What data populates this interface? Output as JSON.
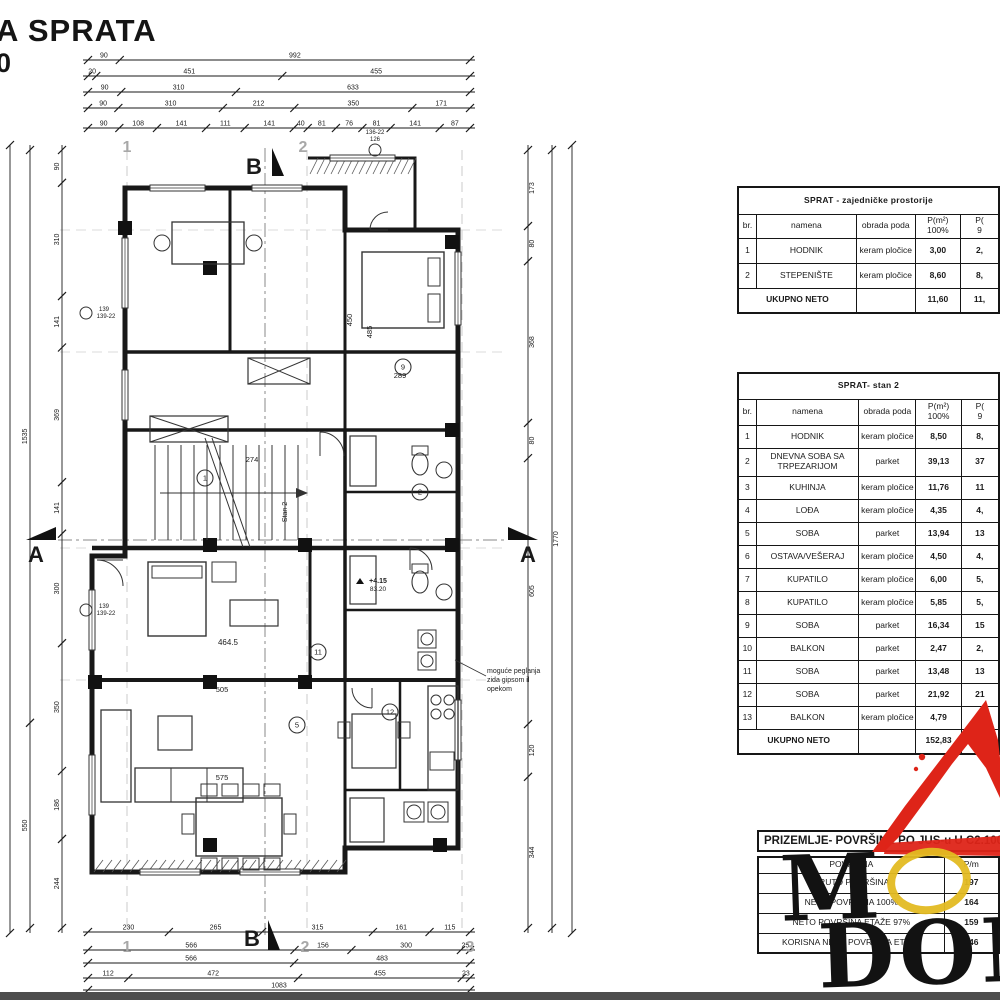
{
  "title": {
    "heading": "A SPRATA",
    "scale": "0"
  },
  "tables": {
    "common": {
      "title": "SPRAT - zajedničke prostorije",
      "columns": [
        {
          "l1": "br."
        },
        {
          "l1": "namena"
        },
        {
          "l1": "obrada poda"
        },
        {
          "l1": "P(m²)",
          "l2": "100%"
        },
        {
          "l1": "P(",
          "l2": "9"
        }
      ],
      "rows": [
        [
          "1",
          "HODNIK",
          "keram pločice",
          "3,00",
          "2,"
        ],
        [
          "2",
          "STEPENIŠTE",
          "keram pločice",
          "8,60",
          "8,"
        ]
      ],
      "footer": [
        "UKUPNO NETO",
        "",
        "11,60",
        "11,"
      ]
    },
    "stan2": {
      "title": "SPRAT- stan 2",
      "columns": [
        {
          "l1": "br."
        },
        {
          "l1": "namena"
        },
        {
          "l1": "obrada poda"
        },
        {
          "l1": "P(m²)",
          "l2": "100%"
        },
        {
          "l1": "P(",
          "l2": "9"
        }
      ],
      "rows": [
        [
          "1",
          "HODNIK",
          "keram pločice",
          "8,50",
          "8,"
        ],
        [
          "2",
          "DNEVNA SOBA SA TRPEZARIJOM",
          "parket",
          "39,13",
          "37"
        ],
        [
          "3",
          "KUHINJA",
          "keram pločice",
          "11,76",
          "11"
        ],
        [
          "4",
          "LOĐA",
          "keram pločice",
          "4,35",
          "4,"
        ],
        [
          "5",
          "SOBA",
          "parket",
          "13,94",
          "13"
        ],
        [
          "6",
          "OSTAVA/VEŠERAJ",
          "keram pločice",
          "4,50",
          "4,"
        ],
        [
          "7",
          "KUPATILO",
          "keram pločice",
          "6,00",
          "5,"
        ],
        [
          "8",
          "KUPATILO",
          "keram pločice",
          "5,85",
          "5,"
        ],
        [
          "9",
          "SOBA",
          "parket",
          "16,34",
          "15"
        ],
        [
          "10",
          "BALKON",
          "parket",
          "2,47",
          "2,"
        ],
        [
          "11",
          "SOBA",
          "parket",
          "13,48",
          "13"
        ],
        [
          "12",
          "SOBA",
          "parket",
          "21,92",
          "21"
        ],
        [
          "13",
          "BALKON",
          "keram pločice",
          "4,79",
          "4,"
        ]
      ],
      "footer": [
        "UKUPNO NETO",
        "",
        "152,83",
        "145"
      ]
    },
    "prizemlje": {
      "title": "PRIZEMLJE- POVRŠINE PO JUS-u U C2.100",
      "headers": [
        "POVRŠINA",
        "P/m"
      ],
      "rows": [
        [
          "BRUTO POVRŠINA",
          "197"
        ],
        [
          "NETO POVRŠINA 100%",
          "164"
        ],
        [
          "NETO POVRŠINA ETAŽE 97%",
          "159"
        ],
        [
          "KORISNA NETO POVRŠINA ETAŽE",
          "146"
        ]
      ]
    }
  },
  "plan": {
    "note": "moguće peglanja\nzida gipsom il\nopekom",
    "section_markers": {
      "a": "A",
      "b": "B"
    },
    "grid_bubbles": [
      "1",
      "2",
      "3"
    ],
    "room_numbers": [
      "1",
      "2",
      "9",
      "11",
      "5",
      "12"
    ],
    "labels": {
      "stan": "Stan 2",
      "area1": "464.5",
      "area2": "505",
      "area3": "575",
      "area4": "289",
      "dim_274": "274",
      "dim_450": "450",
      "dim_485": "485",
      "elev1": "+4.15",
      "elev2": "83.20",
      "win1": "139",
      "win1b": "139-22",
      "win2": "126",
      "win2b": "136-22"
    },
    "dims": {
      "top": [
        [
          "90",
          "992"
        ],
        [
          "20",
          "451",
          "455"
        ],
        [
          "90",
          "310",
          "633"
        ],
        [
          "90",
          "310",
          "212",
          "350",
          "171"
        ],
        [
          "90",
          "108",
          "141",
          "111",
          "141",
          "40",
          "81",
          "76",
          "81",
          "141",
          "87"
        ]
      ],
      "bottom": [
        [
          "230",
          "265",
          "315",
          "161",
          "115"
        ],
        [
          "566",
          "156",
          "300",
          "25"
        ],
        [
          "566",
          "483"
        ],
        [
          "112",
          "472",
          "455",
          "23"
        ],
        [
          "1083"
        ]
      ],
      "left": [
        [
          "90",
          "310",
          "141",
          "369",
          "141",
          "300",
          "350",
          "186",
          "244"
        ],
        [
          "1535",
          "550"
        ]
      ],
      "right": [
        [
          "173",
          "80",
          "368",
          "80",
          "605",
          "120",
          "344"
        ],
        [
          "1770"
        ]
      ]
    }
  },
  "watermark": {
    "line1": "M",
    "line2": "DOM",
    "red": "#de2418",
    "yellow": "#e3ba22"
  }
}
